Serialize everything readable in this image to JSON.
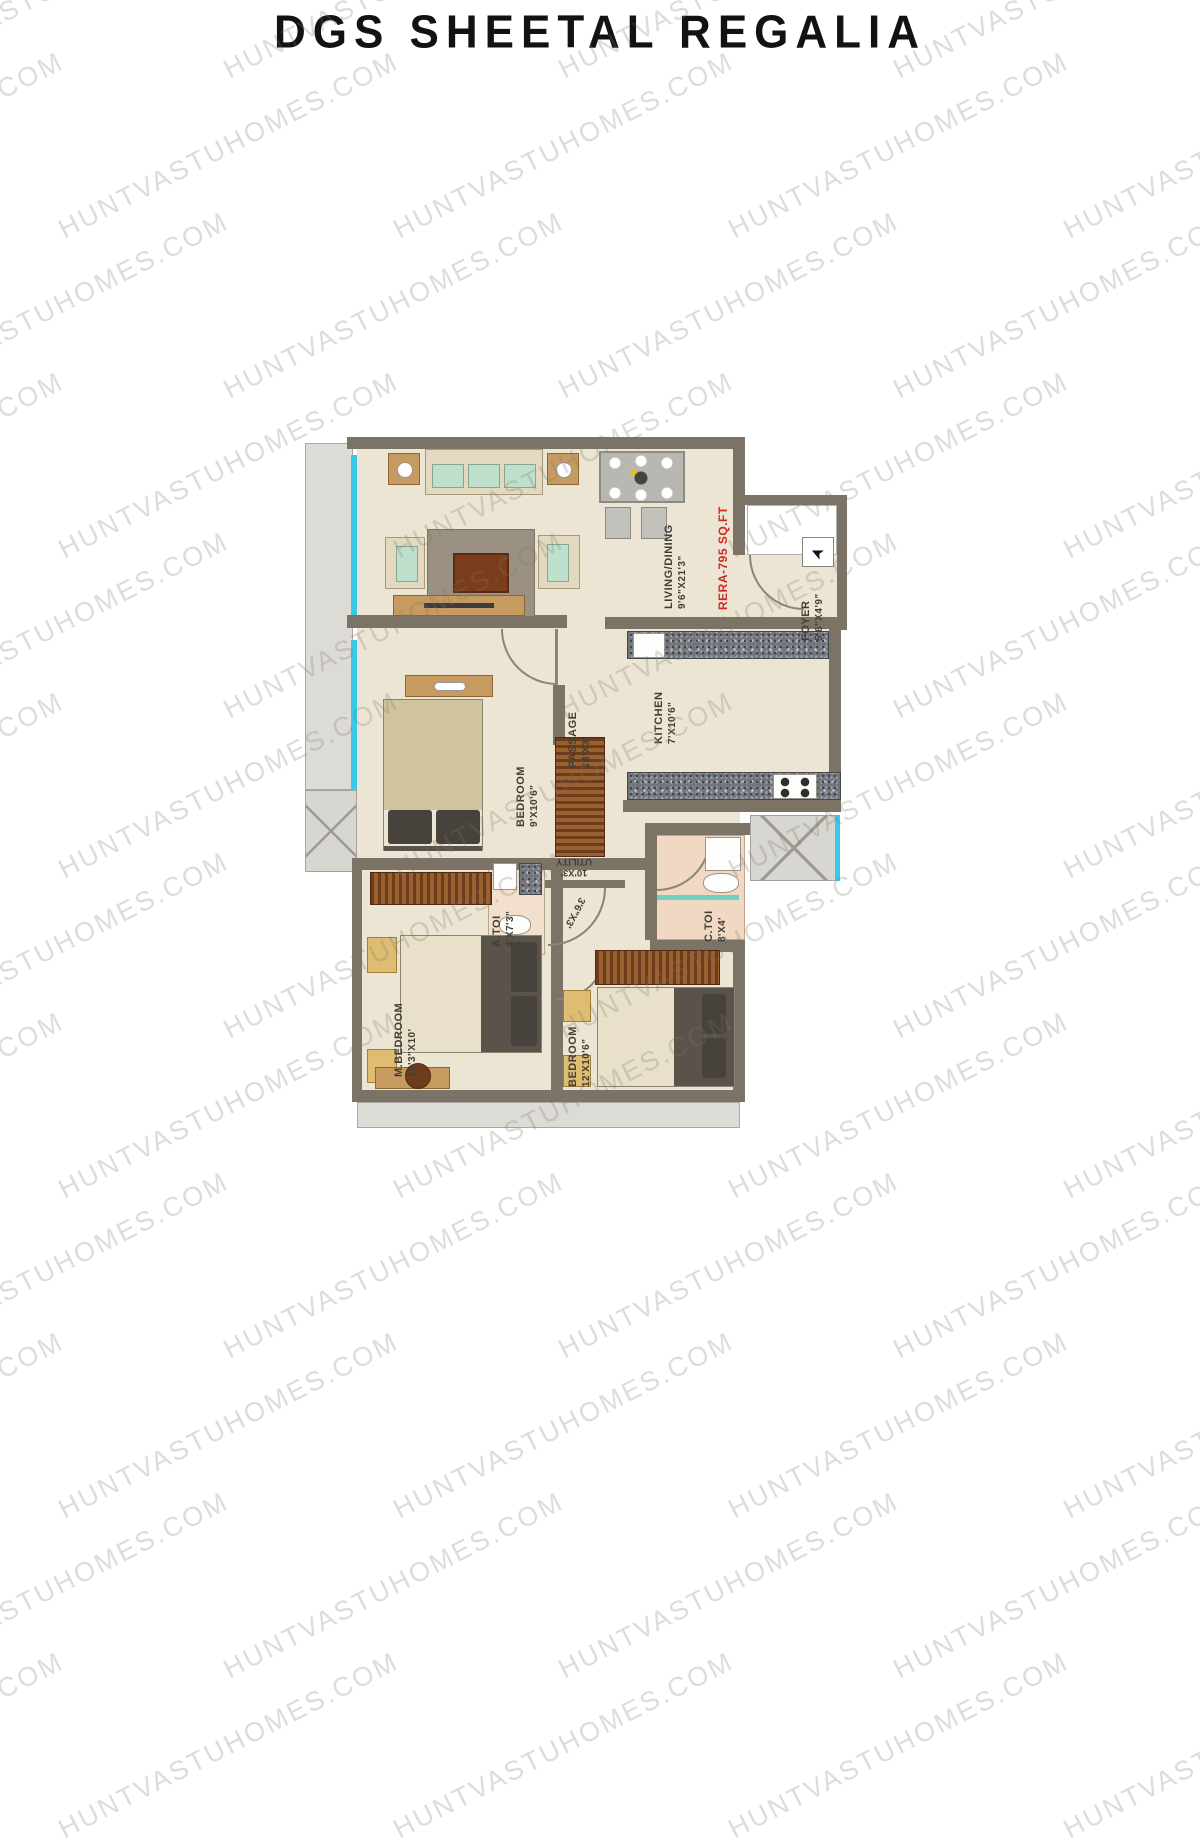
{
  "title": "DGS SHEETAL REGALIA",
  "watermark": {
    "text": "HUNTVASTUHOMES.COM"
  },
  "plan": {
    "rera_label": "RERA-795 SQ.FT",
    "entry_arrow": "➤",
    "rooms": {
      "living": {
        "name": "LIVING/DINING",
        "dims": "9'6\"X21'3\""
      },
      "foyer": {
        "name": "FOYER",
        "dims": "5'6\"X4'9\""
      },
      "kitchen": {
        "name": "KITCHEN",
        "dims": "7'X10'6\""
      },
      "passage": {
        "name": "PASSAGE",
        "dims": "14'X3'"
      },
      "bedroom_top": {
        "name": "BEDROOM",
        "dims": "9'X10'6\""
      },
      "utility": {
        "name": "UTILITY",
        "dims": "10'X3'"
      },
      "lobby": {
        "dims": "3'6\"X3'"
      },
      "a_toi": {
        "name": "A.TOI",
        "dims": "4'X7'3\""
      },
      "c_toi": {
        "name": "C.TOI",
        "dims": "8'X4'"
      },
      "m_bedroom": {
        "name": "M.BEDROOM",
        "dims": "12'3\"X10'"
      },
      "bedroom_right": {
        "name": "BEDROOM",
        "dims": "12'X10'6\""
      }
    }
  }
}
